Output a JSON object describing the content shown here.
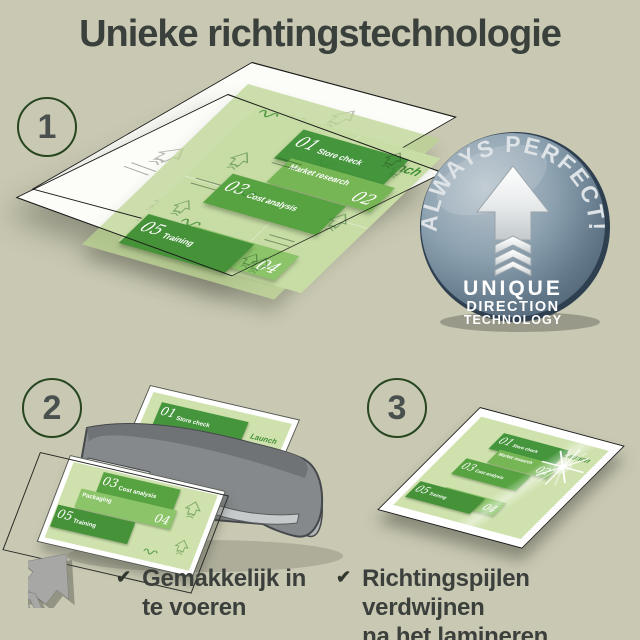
{
  "title": "Unieke richtingstechnologie",
  "steps": [
    {
      "label": "1"
    },
    {
      "label": "2"
    },
    {
      "label": "3"
    }
  ],
  "badge": {
    "arc_text": "ALWAYS PERFECT!",
    "line1": "UNIQUE",
    "line2": "DIRECTION",
    "line3": "TECHNOLOGY"
  },
  "document": {
    "launch": "Launch",
    "items": [
      {
        "num": "01",
        "label": "Store check"
      },
      {
        "num": "02",
        "label": "Market research"
      },
      {
        "num": "03",
        "label": "Cost analysis"
      },
      {
        "num": "04",
        "label": "Packaging"
      },
      {
        "num": "05",
        "label": "Training"
      }
    ]
  },
  "bullets": [
    {
      "line1": "Gemakkelijk in",
      "line2": "te voeren"
    },
    {
      "line1": "Richtingspijlen verdwijnen",
      "line2": "na het lamineren"
    }
  ],
  "icons": {
    "check": "✔"
  },
  "colors": {
    "background": "#c9c9b3",
    "title": "#3a403c",
    "step_ring": "#27461f",
    "step_number": "#4a504e",
    "badge_face": "#8195a5",
    "badge_rim": "#3c4f61",
    "block_green_dark": "#44953c",
    "block_green_mid": "#58a341",
    "block_green_light": "#77b655",
    "block_green_lighter": "#8cc46a",
    "pouch_green": "#cfe2ae"
  }
}
